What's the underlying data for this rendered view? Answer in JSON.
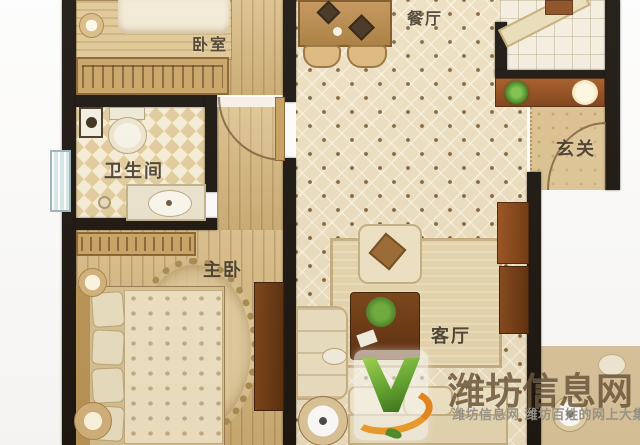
{
  "image": {
    "type": "apartment floor plan photo",
    "width_px": 640,
    "height_px": 445
  },
  "rooms": [
    {
      "id": "bedroom",
      "label": "卧室"
    },
    {
      "id": "dining",
      "label": "餐厅"
    },
    {
      "id": "entry",
      "label": "玄关"
    },
    {
      "id": "bathroom",
      "label": "卫生间"
    },
    {
      "id": "master",
      "label": "主卧"
    },
    {
      "id": "living",
      "label": "客厅"
    }
  ],
  "watermark": {
    "brand": "潍坊信息网",
    "tagline": "潍坊信息网 潍坊百姓的网上大集",
    "logo": "green-v-checkmark-with-orange-swoosh",
    "colors": {
      "brand_text": "#6b553a",
      "tagline_text": "#9b958a",
      "logo_green": "#5fa32e",
      "logo_orange": "#e8942a"
    }
  },
  "palette": {
    "wall": "#1b1510",
    "wood_floor": "#d6b77c",
    "diamond_tile": "#ecdfc1",
    "background": "#ffffff"
  }
}
